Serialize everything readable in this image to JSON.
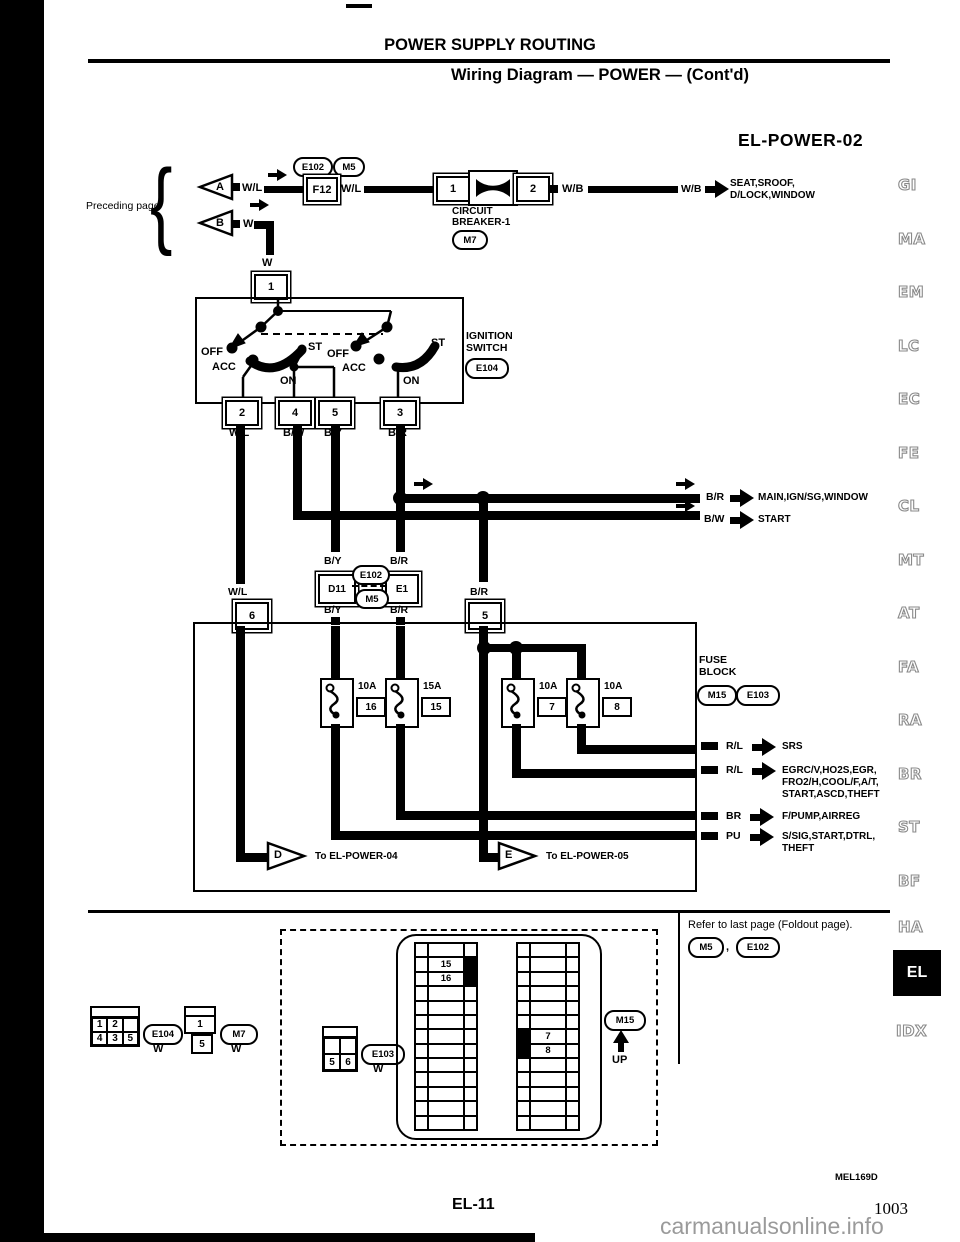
{
  "header": {
    "title": "POWER SUPPLY ROUTING",
    "subtitle": "Wiring Diagram — POWER — (Cont'd)",
    "diagram_id": "EL-POWER-02"
  },
  "preceding": {
    "label": "Preceding page",
    "brace": "{",
    "a": "A",
    "a_wire": "W/L",
    "b": "B",
    "b_wire": "W",
    "w_drop": "W",
    "t1": "1"
  },
  "top": {
    "e102": "E102",
    "m5": "M5",
    "f12": "F12",
    "wl2": "W/L",
    "cb1": "1",
    "cb2": "2",
    "wb": "W/B",
    "wb2": "W/B",
    "cb_line1": "CIRCUIT",
    "cb_line2": "BREAKER-1",
    "m7": "M7",
    "dest_line1": "SEAT,SROOF,",
    "dest_line2": "D/LOCK,WINDOW"
  },
  "ignition": {
    "line1": "IGNITION",
    "line2": "SWITCH",
    "conn": "E104",
    "l_off": "OFF",
    "l_acc": "ACC",
    "l_on": "ON",
    "l_st": "ST",
    "r_off": "OFF",
    "r_acc": "ACC",
    "r_on": "ON",
    "r_st": "ST",
    "t2": "2",
    "t4": "4",
    "t5": "5",
    "t3": "3",
    "w_wl": "W/L",
    "w_bw": "B/W",
    "w_by": "B/Y",
    "w_br": "B/R"
  },
  "mid": {
    "br": "B/R",
    "br_dest": "MAIN,IGN/SG,WINDOW",
    "bw": "B/W",
    "bw_dest": "START",
    "by_above": "B/Y",
    "br_above": "B/R",
    "d11": "D11",
    "e1": "E1",
    "e102": "E102",
    "m5": "M5",
    "by_below": "B/Y",
    "br_below": "B/R",
    "wl": "W/L",
    "br_t5": "B/R",
    "t6": "6",
    "t5": "5"
  },
  "fuse_block": {
    "line1": "FUSE",
    "line2": "BLOCK",
    "m15": "M15",
    "e103": "E103",
    "fuses": [
      {
        "amp": "10A",
        "num": "16"
      },
      {
        "amp": "15A",
        "num": "15"
      },
      {
        "amp": "10A",
        "num": "7"
      },
      {
        "amp": "10A",
        "num": "8"
      }
    ],
    "d": "D",
    "d_dest": "To EL-POWER-04",
    "e": "E",
    "e_dest": "To EL-POWER-05"
  },
  "outputs": [
    {
      "wire": "R/L",
      "lines": [
        "SRS"
      ]
    },
    {
      "wire": "R/L",
      "lines": [
        "EGRC/V,HO2S,EGR,",
        "FRO2/H,COOL/F,A/T,",
        "START,ASCD,THEFT"
      ]
    },
    {
      "wire": "BR",
      "lines": [
        "F/PUMP,AIRREG"
      ]
    },
    {
      "wire": "PU",
      "lines": [
        "S/SIG,START,DTRL,",
        "THEFT"
      ]
    }
  ],
  "connectors": {
    "e104": {
      "cells": [
        "1",
        "2",
        "",
        "4",
        "3",
        "5"
      ],
      "name": "E104",
      "color": "W"
    },
    "m7": {
      "top": "1",
      "bottom": "5",
      "name": "M7",
      "color": "W"
    },
    "e103": {
      "c1": "5",
      "c2": "6",
      "name": "E103",
      "color": "W"
    },
    "fusebox": {
      "r15": "15",
      "r16": "16",
      "r7": "7",
      "r8": "8",
      "name": "M15",
      "up": "UP"
    }
  },
  "note": {
    "text": "Refer to last page (Foldout page).",
    "m5": "M5",
    "comma": ",",
    "e102": "E102"
  },
  "margin": [
    "GI",
    "MA",
    "EM",
    "LC",
    "EC",
    "FE",
    "CL",
    "MT",
    "AT",
    "FA",
    "RA",
    "BR",
    "ST",
    "BF",
    "HA",
    "EL",
    "IDX"
  ],
  "footer": {
    "code": "MEL169D",
    "page": "EL-11",
    "number": "1003",
    "watermark": "carmanualsonline.info"
  },
  "colors": {
    "ink": "#000000",
    "margin_gray": "#8a8a8a",
    "watermark_gray": "#9a9a9a"
  }
}
